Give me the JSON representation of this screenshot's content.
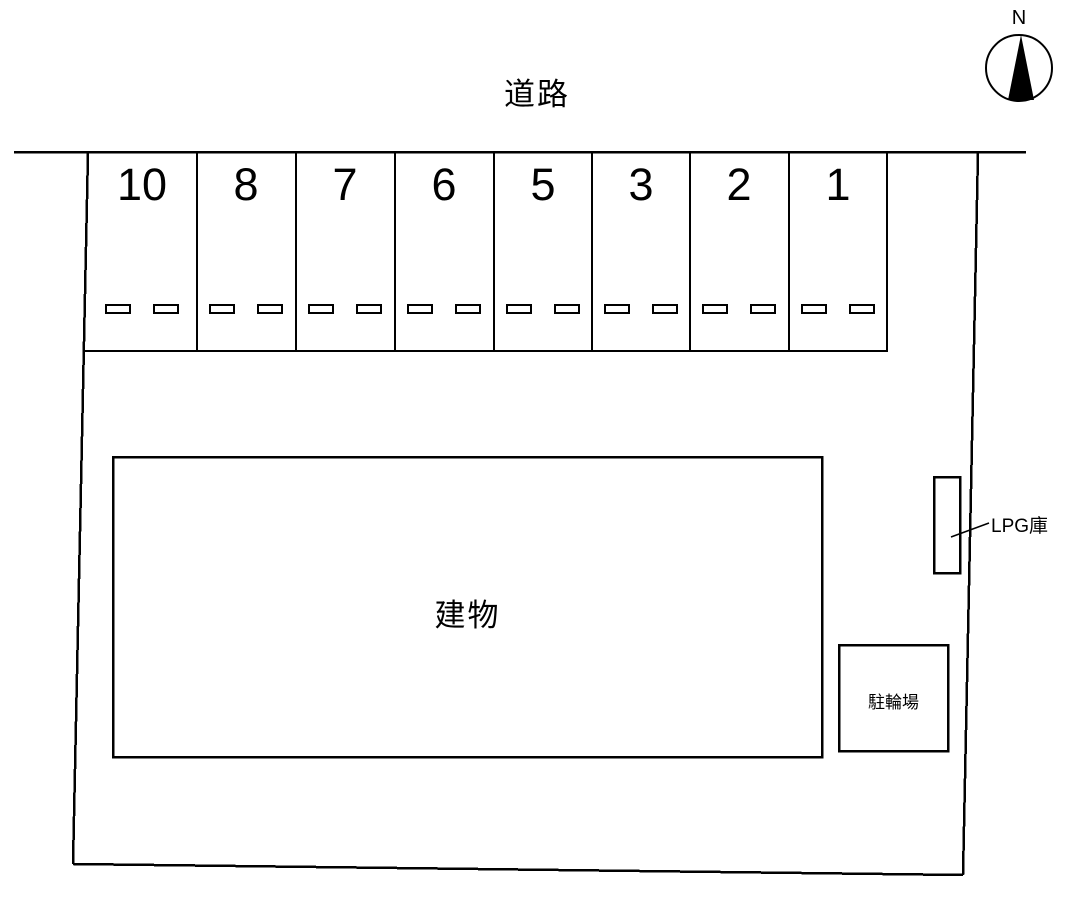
{
  "road": {
    "label": "道路"
  },
  "compass": {
    "north": "N"
  },
  "parking": {
    "spaces": [
      "10",
      "8",
      "7",
      "6",
      "5",
      "3",
      "2",
      "1"
    ]
  },
  "building": {
    "label": "建物"
  },
  "lpg": {
    "label": "LPG庫"
  },
  "bicycle": {
    "label": "駐輪場"
  },
  "colors": {
    "line": "#000000",
    "background": "#ffffff"
  }
}
